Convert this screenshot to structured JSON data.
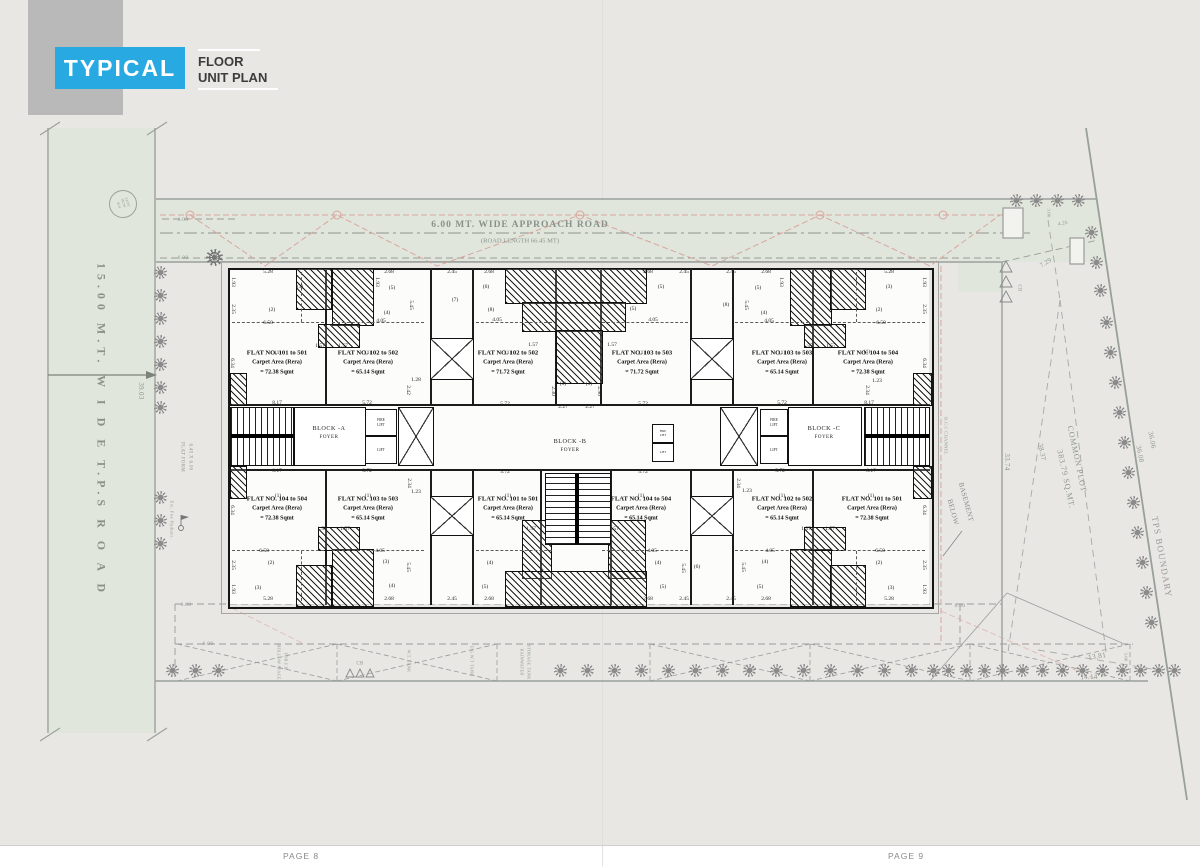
{
  "title_block": {
    "typical": "TYPICAL",
    "floor": "FLOOR",
    "unit_plan": "UNIT PLAN",
    "accent": "#29a9e2"
  },
  "pages": {
    "page8": "PAGE 8",
    "page9": "PAGE 9"
  },
  "roads": {
    "approach": "6.00 MT. WIDE APPROACH ROAD",
    "approach_len": "(ROAD LENGTH 66.45 MT)",
    "tps": "15.00  M.T.  W I D E  T.P.S  R O A D",
    "manhole": "EXIST MUNI. M.H"
  },
  "site": {
    "common_plot_1": "COMMON PLOT",
    "common_plot_2": "383.79 SQ.MT.",
    "tps_boundary": "TPS BOUNDARY",
    "basement_1": "BASEMENT",
    "basement_2": "BELOW",
    "rcc_channel": "R.C.C CHANNEL"
  },
  "blocks": {
    "a": "BLOCK -A",
    "b": "BLOCK -B",
    "c": "BLOCK -C",
    "foyer": "FOYER",
    "fire_lift": "FIRE LIFT",
    "lift": "LIFT"
  },
  "flats": {
    "top": [
      {
        "no": "FLAT NO. 101 to 501",
        "carpet": "Carpet Area (Rera)",
        "area": "= 72.38 Sqmt"
      },
      {
        "no": "FLAT NO. 102 to 502",
        "carpet": "Carpet Area (Rera)",
        "area": "= 65.14 Sqmt"
      },
      {
        "no": "FLAT NO. 102 to 502",
        "carpet": "Carpet Area (Rera)",
        "area": "= 71.72 Sqmt"
      },
      {
        "no": "FLAT NO. 103 to 503",
        "carpet": "Carpet Area (Rera)",
        "area": "= 71.72 Sqmt"
      },
      {
        "no": "FLAT NO. 103 to 503",
        "carpet": "Carpet Area (Rera)",
        "area": "= 65.14 Sqmt"
      },
      {
        "no": "FLAT NO. 104 to 504",
        "carpet": "Carpet Area (Rera)",
        "area": "= 72.38 Sqmt"
      }
    ],
    "bottom": [
      {
        "no": "FLAT NO. 104 to 504",
        "carpet": "Carpet Area (Rera)",
        "area": "= 72.38 Sqmt"
      },
      {
        "no": "FLAT NO. 103 to 503",
        "carpet": "Carpet Area (Rera)",
        "area": "= 65.14 Sqmt"
      },
      {
        "no": "FLAT NO. 101 to 501",
        "carpet": "Carpet Area (Rera)",
        "area": "= 65.14 Sqmt"
      },
      {
        "no": "FLAT NO. 104 to 504",
        "carpet": "Carpet Area (Rera)",
        "area": "= 65.14 Sqmt"
      },
      {
        "no": "FLAT NO. 102 to 502",
        "carpet": "Carpet Area (Rera)",
        "area": "= 65.14 Sqmt"
      },
      {
        "no": "FLAT NO. 101 to 501",
        "carpet": "Carpet Area (Rera)",
        "area": "= 72.38 Sqmt"
      }
    ]
  },
  "plan_labels": [
    [
      "5.28",
      268,
      272
    ],
    [
      "2.68",
      389,
      272
    ],
    [
      "2.45",
      452,
      272
    ],
    [
      "2.68",
      489,
      272
    ],
    [
      "2.68",
      648,
      272
    ],
    [
      "2.45",
      684,
      272
    ],
    [
      "2.45",
      731,
      272
    ],
    [
      "2.68",
      766,
      272
    ],
    [
      "5.28",
      889,
      272
    ],
    [
      "1.93",
      233,
      282,
      90
    ],
    [
      "2.35",
      233,
      309,
      90
    ],
    [
      "6.34",
      232,
      363,
      90
    ],
    [
      "6.34",
      232,
      510,
      90
    ],
    [
      "2.35",
      233,
      565,
      90
    ],
    [
      "1.93",
      233,
      589,
      90
    ],
    [
      "1.93",
      924,
      282,
      90
    ],
    [
      "2.35",
      924,
      309,
      90
    ],
    [
      "6.34",
      924,
      363,
      90
    ],
    [
      "6.34",
      924,
      510,
      90
    ],
    [
      "2.35",
      924,
      565,
      90
    ],
    [
      "1.93",
      924,
      589,
      90
    ],
    [
      "1.93",
      377,
      282,
      90
    ],
    [
      "5.45",
      411,
      305,
      90
    ],
    [
      "1.93",
      781,
      282,
      90
    ],
    [
      "5.45",
      746,
      305,
      90
    ],
    [
      "(3)",
      300,
      287
    ],
    [
      "(2)",
      272,
      310
    ],
    [
      "(5)",
      392,
      288
    ],
    [
      "(4)",
      387,
      313
    ],
    [
      "(6)",
      486,
      287
    ],
    [
      "(7)",
      455,
      300
    ],
    [
      "(8)",
      491,
      310
    ],
    [
      "(5)",
      661,
      287
    ],
    [
      "(5)",
      633,
      309
    ],
    [
      "(5)",
      758,
      288
    ],
    [
      "(8)",
      726,
      305
    ],
    [
      "(4)",
      764,
      313
    ],
    [
      "(3)",
      889,
      287
    ],
    [
      "(2)",
      879,
      310
    ],
    [
      "6.50",
      268,
      323
    ],
    [
      "4.05",
      381,
      321
    ],
    [
      "4.05",
      497,
      320
    ],
    [
      "4.05",
      653,
      320
    ],
    [
      "4.05",
      769,
      321
    ],
    [
      "6.50",
      881,
      323
    ],
    [
      "1.57",
      320,
      346
    ],
    [
      "1.57",
      343,
      346
    ],
    [
      "1.57",
      533,
      345
    ],
    [
      "1.57",
      612,
      345
    ],
    [
      "1.57",
      808,
      346
    ],
    [
      "1.57",
      831,
      346
    ],
    [
      "(1)",
      278,
      353
    ],
    [
      "(1)",
      368,
      353
    ],
    [
      "(1)",
      508,
      353
    ],
    [
      "(1)",
      642,
      353
    ],
    [
      "(1)",
      782,
      353
    ],
    [
      "(1)",
      867,
      352
    ],
    [
      "(1)",
      563,
      384
    ],
    [
      "(1)",
      589,
      384
    ],
    [
      "2.30",
      553,
      391,
      90
    ],
    [
      "2.90",
      599,
      391,
      90
    ],
    [
      "2.27",
      563,
      407
    ],
    [
      "2.27",
      590,
      407
    ],
    [
      "1.28",
      416,
      380
    ],
    [
      "2.42",
      408,
      390,
      90
    ],
    [
      "1.23",
      877,
      381
    ],
    [
      "2.34",
      867,
      390,
      90
    ],
    [
      "8.17",
      277,
      403
    ],
    [
      "5.72",
      367,
      403
    ],
    [
      "5.72",
      505,
      404
    ],
    [
      "5.72",
      643,
      404
    ],
    [
      "5.72",
      782,
      403
    ],
    [
      "8.17",
      869,
      403
    ],
    [
      "8.17",
      277,
      471
    ],
    [
      "5.72",
      367,
      471
    ],
    [
      "5.72",
      505,
      472
    ],
    [
      "5.72",
      643,
      472
    ],
    [
      "5.72",
      780,
      471
    ],
    [
      "8.17",
      871,
      471
    ],
    [
      "2.34",
      409,
      483,
      90
    ],
    [
      "1.23",
      416,
      492
    ],
    [
      "2.34",
      738,
      483,
      90
    ],
    [
      "1.23",
      747,
      491
    ],
    [
      "(1)",
      278,
      496
    ],
    [
      "(1)",
      368,
      496
    ],
    [
      "(1)",
      508,
      496
    ],
    [
      "(1)",
      641,
      496
    ],
    [
      "(1)",
      782,
      496
    ],
    [
      "(1)",
      871,
      496
    ],
    [
      "1.57",
      322,
      529
    ],
    [
      "1.57",
      345,
      529
    ],
    [
      "1.57",
      531,
      529
    ],
    [
      "1.57",
      614,
      529
    ],
    [
      "1.57",
      806,
      529
    ],
    [
      "1.57",
      830,
      529
    ],
    [
      "6.50",
      264,
      551
    ],
    [
      "4.05",
      380,
      551
    ],
    [
      "4.05",
      652,
      551
    ],
    [
      "4.05",
      770,
      551
    ],
    [
      "6.50",
      880,
      551
    ],
    [
      "5.45",
      408,
      567,
      90
    ],
    [
      "5.45",
      541,
      568,
      90
    ],
    [
      "5.45",
      683,
      568,
      90
    ],
    [
      "5.45",
      743,
      567,
      90
    ],
    [
      "(6)",
      697,
      567
    ],
    [
      "(2)",
      271,
      563
    ],
    [
      "(3)",
      258,
      588
    ],
    [
      "(3)",
      386,
      562
    ],
    [
      "(4)",
      392,
      586
    ],
    [
      "(4)",
      490,
      563
    ],
    [
      "(5)",
      485,
      587
    ],
    [
      "(4)",
      658,
      563
    ],
    [
      "(5)",
      663,
      587
    ],
    [
      "(4)",
      765,
      562
    ],
    [
      "(5)",
      760,
      587
    ],
    [
      "(2)",
      879,
      563
    ],
    [
      "(3)",
      891,
      588
    ],
    [
      "5.28",
      268,
      599
    ],
    [
      "2.68",
      389,
      599
    ],
    [
      "2.45",
      452,
      599
    ],
    [
      "2.68",
      489,
      599
    ],
    [
      "2.68",
      648,
      599
    ],
    [
      "2.45",
      684,
      599
    ],
    [
      "2.45",
      731,
      599
    ],
    [
      "2.68",
      766,
      599
    ],
    [
      "5.28",
      889,
      599
    ]
  ],
  "site_labels": [
    [
      "6.00",
      183,
      220,
      0,
      5.5
    ],
    [
      "6.00",
      183,
      258,
      0,
      5.5
    ],
    [
      "6.00",
      186,
      605,
      0,
      5.5
    ],
    [
      "6.00",
      208,
      644,
      0,
      5.5
    ],
    [
      "6.00",
      960,
      606,
      0,
      5.5
    ],
    [
      "39.03",
      141,
      391,
      90,
      7
    ],
    [
      "33.74",
      1007,
      462,
      90,
      7
    ],
    [
      "36.06",
      1152,
      440,
      79,
      7
    ],
    [
      "36.08",
      1140,
      454,
      79,
      7
    ],
    [
      "38.37",
      1042,
      452,
      78,
      7
    ],
    [
      "13.81",
      1097,
      656,
      -9,
      7.5
    ],
    [
      "14.14",
      1089,
      677,
      -2,
      7
    ],
    [
      "7.29",
      1046,
      263,
      -33,
      6.5
    ],
    [
      "4.26",
      1063,
      224,
      -10,
      5
    ],
    [
      "3.00",
      1049,
      213,
      90,
      4.5
    ],
    [
      "3.00",
      1126,
      657,
      90,
      4.5
    ],
    [
      "CB",
      1019,
      288,
      90,
      5
    ],
    [
      "CB",
      360,
      664,
      0,
      5
    ],
    [
      "PLAT FORM",
      182,
      457,
      90,
      5
    ],
    [
      "6.45 X 6.00",
      190,
      457,
      90,
      5
    ],
    [
      "Ext. Fire Hydrant",
      172,
      519,
      90,
      4.5
    ],
    [
      "HOLLOW SPACE",
      279,
      662,
      90,
      4.2
    ],
    [
      "FOR F.B.",
      286,
      662,
      90,
      4.2
    ],
    [
      "W.T. TANK",
      409,
      661,
      90,
      4.2
    ],
    [
      "U.G.W.T TANK",
      472,
      661,
      90,
      4.2
    ],
    [
      "RAINWATER",
      522,
      662,
      90,
      4.2
    ],
    [
      "STORAGE TANK",
      529,
      662,
      90,
      4.2
    ]
  ],
  "trees": {
    "positions": [
      [
        160,
        272
      ],
      [
        160,
        295
      ],
      [
        160,
        318
      ],
      [
        160,
        341
      ],
      [
        160,
        364
      ],
      [
        160,
        387
      ],
      [
        160,
        407
      ],
      [
        160,
        497
      ],
      [
        160,
        520
      ],
      [
        160,
        543
      ],
      [
        172,
        670
      ],
      [
        195,
        670
      ],
      [
        218,
        670
      ],
      [
        560,
        670
      ],
      [
        587,
        670
      ],
      [
        614,
        670
      ],
      [
        641,
        670
      ],
      [
        668,
        670
      ],
      [
        695,
        670
      ],
      [
        722,
        670
      ],
      [
        749,
        670
      ],
      [
        776,
        670
      ],
      [
        803,
        670
      ],
      [
        830,
        670
      ],
      [
        857,
        670
      ],
      [
        884,
        670
      ],
      [
        911,
        670
      ],
      [
        933,
        670
      ],
      [
        948,
        670
      ],
      [
        966,
        670
      ],
      [
        984,
        670
      ],
      [
        1002,
        670
      ],
      [
        1022,
        670
      ],
      [
        1042,
        670
      ],
      [
        1062,
        670
      ],
      [
        1082,
        670
      ],
      [
        1102,
        670
      ],
      [
        1122,
        670
      ],
      [
        1140,
        670
      ],
      [
        1158,
        670
      ],
      [
        1174,
        670
      ],
      [
        1016,
        200
      ],
      [
        1036,
        200
      ],
      [
        1057,
        200
      ],
      [
        1078,
        200
      ],
      [
        1091,
        232
      ],
      [
        1096,
        262
      ],
      [
        1100,
        290
      ],
      [
        1106,
        322
      ],
      [
        1110,
        352
      ],
      [
        1115,
        382
      ],
      [
        1119,
        412
      ],
      [
        1124,
        442
      ],
      [
        1128,
        472
      ],
      [
        1133,
        502
      ],
      [
        1137,
        532
      ],
      [
        1142,
        562
      ],
      [
        1146,
        592
      ],
      [
        1151,
        622
      ]
    ]
  }
}
